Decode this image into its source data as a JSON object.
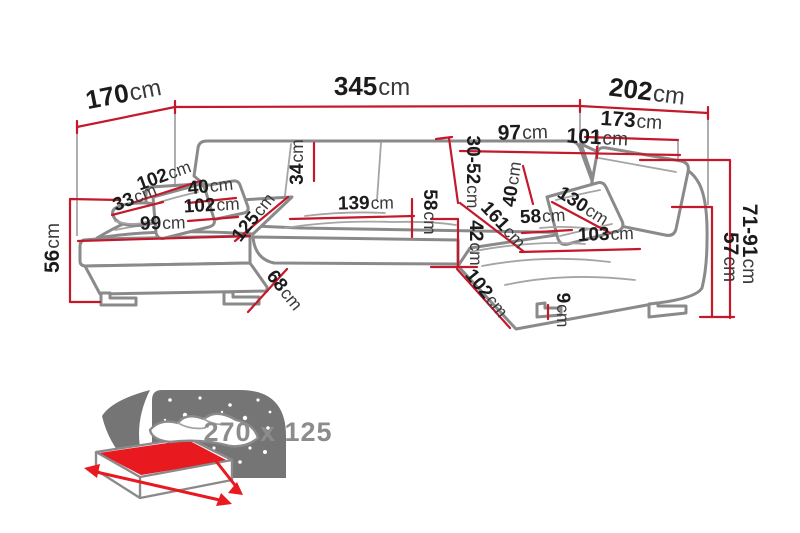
{
  "diagram": {
    "type": "corner-sofa-dimension-diagram",
    "unit": "cm"
  },
  "dimensions": [
    {
      "id": "back-left-depth",
      "value": "170",
      "unit": "cm"
    },
    {
      "id": "total-width",
      "value": "345",
      "unit": "cm"
    },
    {
      "id": "right-side-length",
      "value": "202",
      "unit": "cm"
    },
    {
      "id": "right-inner-length",
      "value": "173",
      "unit": "cm"
    },
    {
      "id": "back-section-left",
      "value": "97",
      "unit": "cm"
    },
    {
      "id": "back-section-right",
      "value": "101",
      "unit": "cm"
    },
    {
      "id": "headrest-adjustable-height",
      "value": "30-52",
      "unit": "cm"
    },
    {
      "id": "backrest-cushion-height",
      "value": "34",
      "unit": "cm"
    },
    {
      "id": "chaise-back-width",
      "value": "102",
      "unit": "cm"
    },
    {
      "id": "bolster-cushion-width",
      "value": "33",
      "unit": "cm"
    },
    {
      "id": "pillow-left-width",
      "value": "40",
      "unit": "cm"
    },
    {
      "id": "chaise-seat-width",
      "value": "102",
      "unit": "cm"
    },
    {
      "id": "chaise-front-width",
      "value": "99",
      "unit": "cm"
    },
    {
      "id": "chaise-seat-depth",
      "value": "125",
      "unit": "cm"
    },
    {
      "id": "center-seat-width",
      "value": "139",
      "unit": "cm"
    },
    {
      "id": "center-seat-depth",
      "value": "58",
      "unit": "cm"
    },
    {
      "id": "seat-height",
      "value": "42",
      "unit": "cm"
    },
    {
      "id": "right-chaise-diagonal",
      "value": "161",
      "unit": "cm"
    },
    {
      "id": "pillow-right-width",
      "value": "40",
      "unit": "cm"
    },
    {
      "id": "right-seat-depth",
      "value": "58",
      "unit": "cm"
    },
    {
      "id": "right-backrest-width",
      "value": "130",
      "unit": "cm"
    },
    {
      "id": "right-front-width",
      "value": "103",
      "unit": "cm"
    },
    {
      "id": "chaise-side-depth",
      "value": "68",
      "unit": "cm"
    },
    {
      "id": "right-side-depth",
      "value": "102",
      "unit": "cm"
    },
    {
      "id": "leg-height",
      "value": "9",
      "unit": "cm"
    },
    {
      "id": "arm-height",
      "value": "56",
      "unit": "cm"
    },
    {
      "id": "seat-back-height",
      "value": "57",
      "unit": "cm"
    },
    {
      "id": "total-height",
      "value": "71-91",
      "unit": "cm"
    }
  ],
  "bed": {
    "sleeping_area": "270 x 125"
  },
  "colors": {
    "dimension_line": "#c4182b",
    "sofa_outline": "#8a8a8a",
    "bed_red": "#e8191f",
    "headboard_gray": "#757575",
    "size_text_gray": "#8c8c8c",
    "label_text": "#1b1b1b"
  }
}
